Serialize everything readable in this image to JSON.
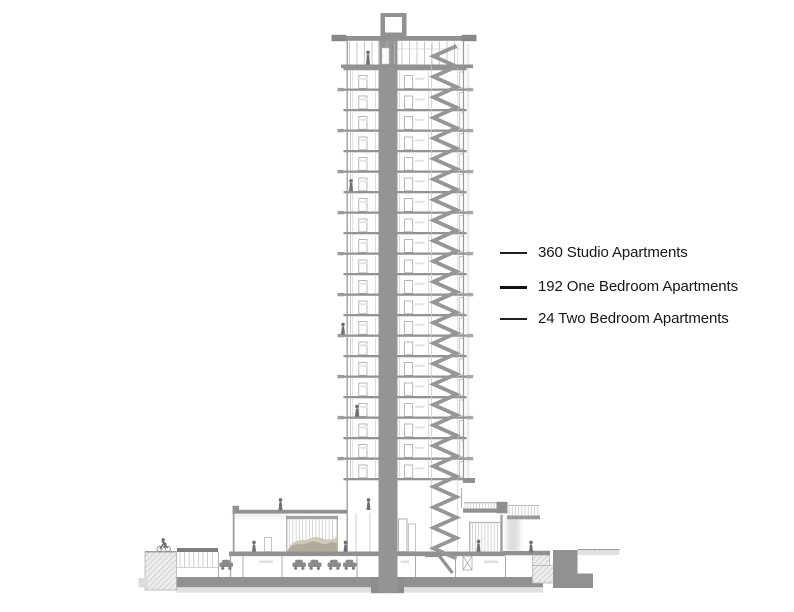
{
  "legend": {
    "items": [
      {
        "label": "360 Studio Apartments",
        "leader": "thin"
      },
      {
        "label": "192 One Bedroom Apartments",
        "leader": "thick"
      },
      {
        "label": "24 Two Bedroom Apartments",
        "leader": "thin"
      }
    ]
  },
  "colors": {
    "ink": "#171717",
    "solid_gray": "#919191",
    "line_gray": "#9a9a9a",
    "light_gray": "#c2c2c2",
    "faint_gray": "#e2e2e2",
    "figure_gray": "#6f6f6f",
    "berm_beige": "#b3aa99",
    "berm_beige_light": "#d0cabb",
    "background": "#ffffff"
  }
}
